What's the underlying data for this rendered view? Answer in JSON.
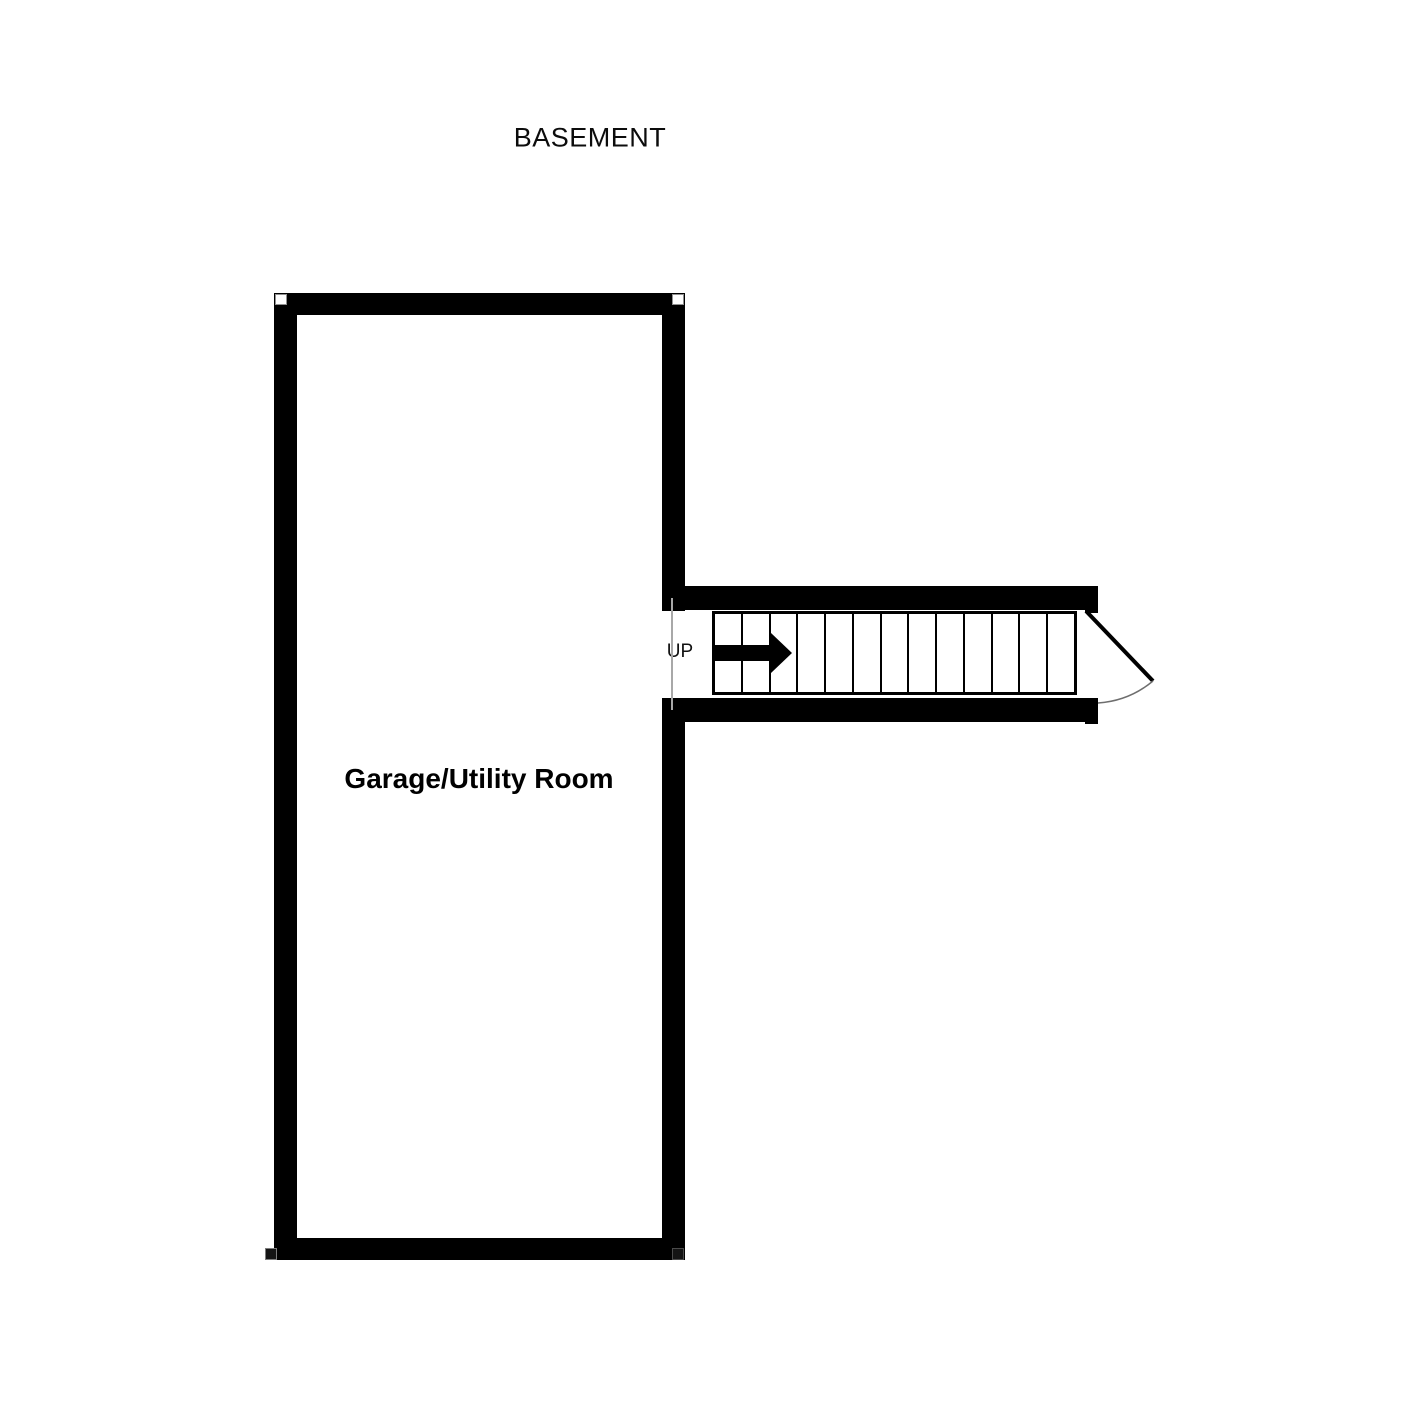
{
  "page": {
    "title": "BASEMENT"
  },
  "rooms": [
    {
      "label": "Garage/Utility Room"
    }
  ],
  "stairs": {
    "label": "UP",
    "tread_count": 13,
    "direction": "right"
  },
  "door": {
    "swing_arc": true
  },
  "colors": {
    "wall": "#000000",
    "background": "#ffffff",
    "opening_line": "#a8a8a8",
    "door_arc": "#6e6e6e"
  }
}
